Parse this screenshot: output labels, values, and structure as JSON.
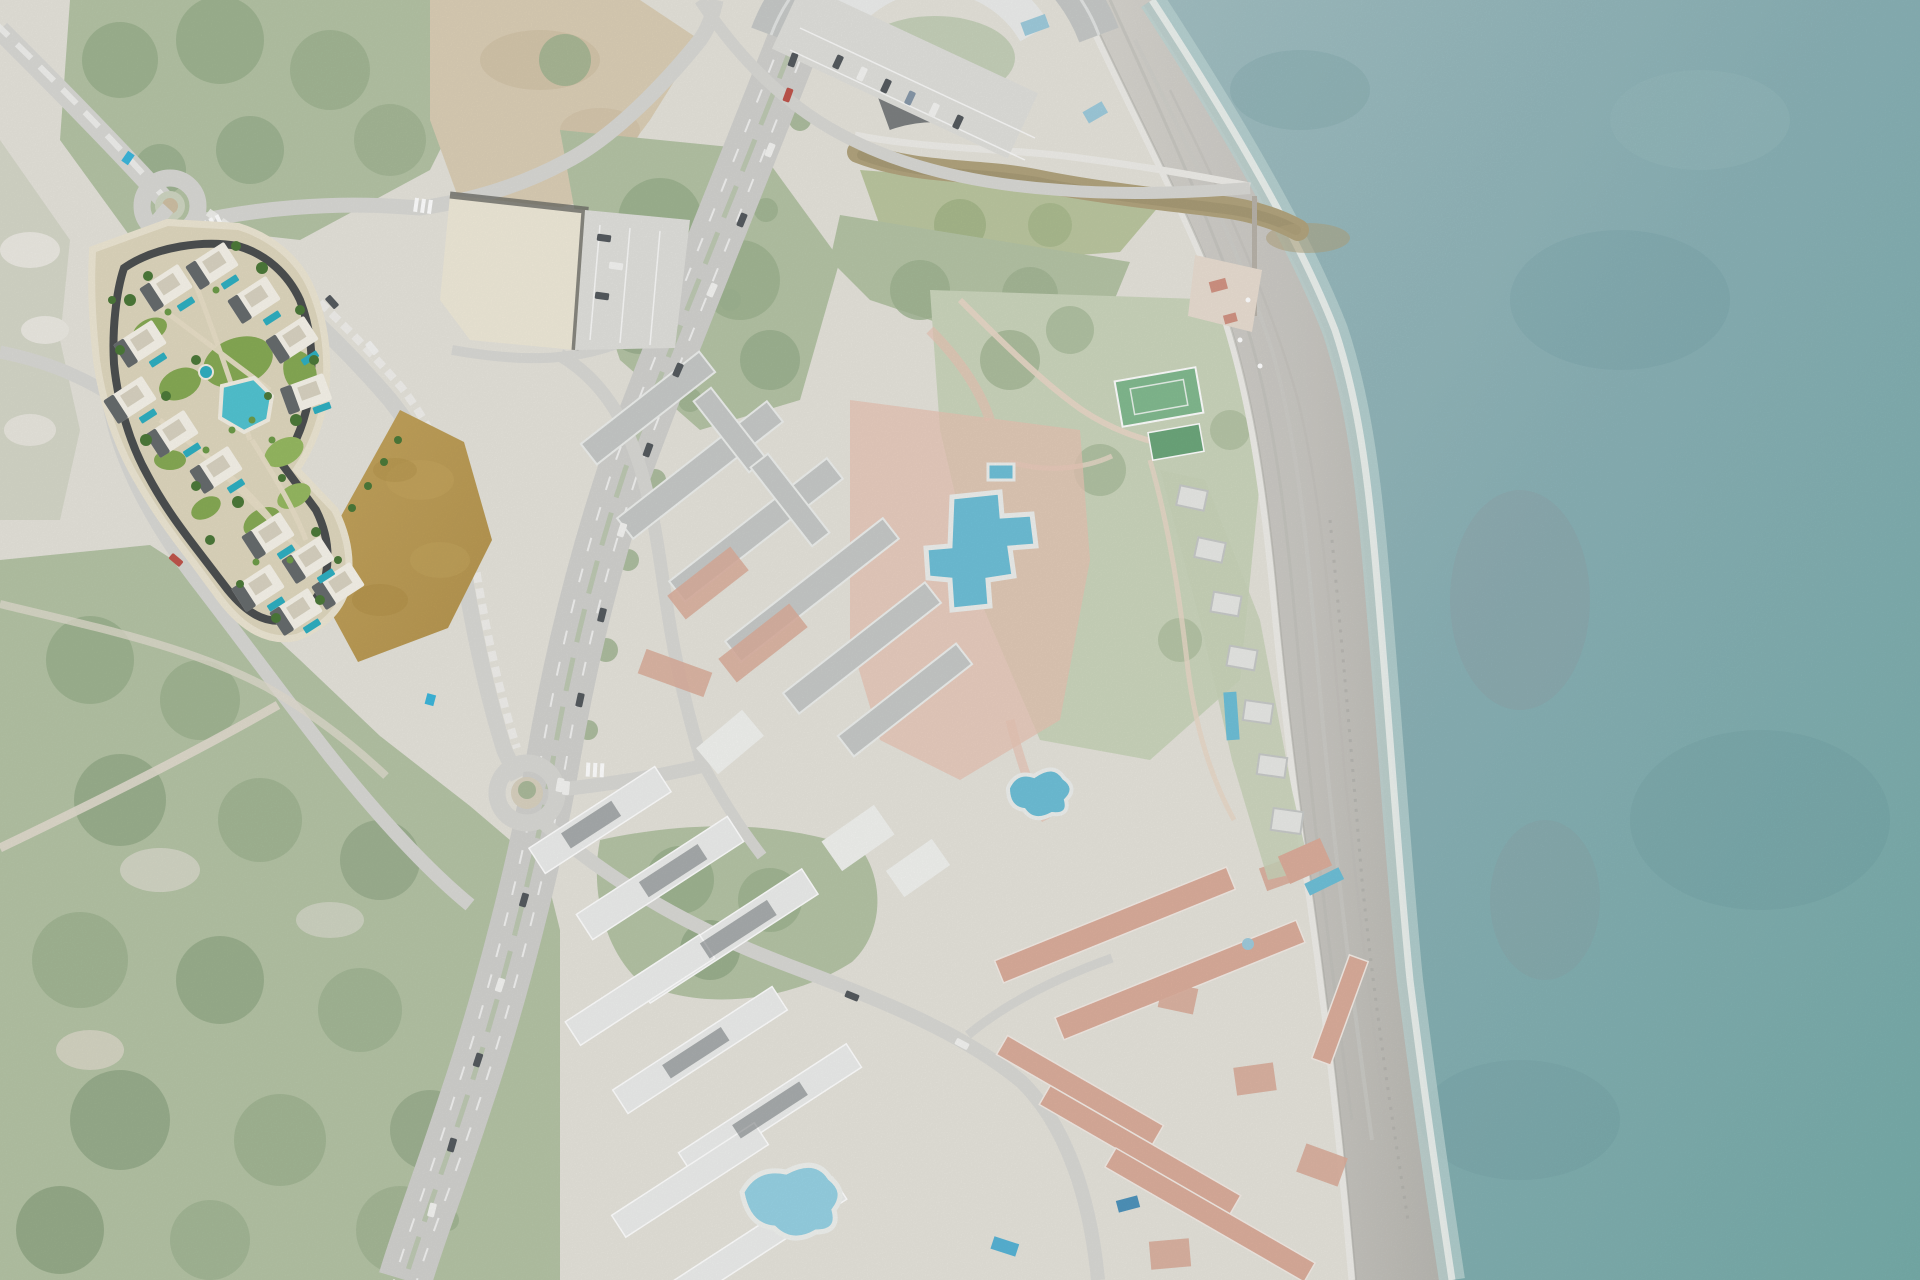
{
  "map": {
    "style": "satellite aerial view of a coastal strip; all surroundings are desaturated / washed out",
    "highlight": "full-colour masterplan render of a new residential development with private pools and a central lagoon pool, upper-left, beside a vacant tan field",
    "regions": [
      "sea",
      "beach",
      "river-mouth",
      "reed-island",
      "circular-apartment-complex",
      "resort-complex-with-pools",
      "white-apartment-blocks",
      "red-roof-townhouses",
      "beachfront-houses",
      "commercial-building",
      "parking-lots",
      "highway",
      "roundabouts",
      "forest-scrubland",
      "tennis-courts",
      "vacant-tan-field"
    ],
    "counts": {
      "roundabouts": 2,
      "tennis_courts": 2,
      "development_private_pools": 13,
      "development_lagoon_pool": 1
    }
  },
  "palette": {
    "land_base": "#e6e4dc",
    "scrub_light": "#d6d8c9",
    "veg_washed": "#b5c4a6",
    "veg_washed_dark": "#9fb491",
    "veg_washed_deep": "#8aa37f",
    "dirt_washed": "#dccfb6",
    "dirt_mottle": "#cfc0a4",
    "dirt_path": "#e3ddd0",
    "road_washed": "#d9d9d5",
    "road_white": "#f2f2ef",
    "highway_washed": "#d2d2cf",
    "parking_washed": "#e1e1dd",
    "building_washed": "#eceeec",
    "roof_gray_washed": "#c7cac8",
    "roof_dark_washed": "#585d61",
    "roof_red_washed": "#dcae9c",
    "terracotta_washed": "#e8c6b6",
    "plaza_washed": "#e9ded2",
    "commercial_roof": "#f0ead9",
    "commercial_edge": "#6e6e68",
    "pool_washed": "#9fccdd",
    "pool_resort": "#6fc0d8",
    "pool_deep_washed": "#4f94bc",
    "court_green": "#83bb90",
    "court_green_dark": "#6da87c",
    "river_water": "#b2a47e",
    "river_dark": "#a1946f",
    "beach_dry": "#d8d6d0",
    "beach_mid": "#cac8c3",
    "beach_wet": "#b9b8b2",
    "beach_streak": "#c0bfba",
    "foam": "#f0f4f1",
    "shallow": "#bed7d6",
    "sea_near": "#a3c0c3",
    "sea_mid": "#8bb2b7",
    "sea_deep": "#77adaa",
    "sea_dark_patch": "#5e8f96",
    "reef_patch": "#9c8e96",
    "promenade": "#efeee9",
    "seawall": "#b0afaa",
    "site_ground": "#e0d8bf",
    "site_sidewalk": "#eee7d4",
    "site_road": "#45494b",
    "site_path": "#e9e0c8",
    "site_lawn": "#87ab55",
    "site_lawn_bright": "#97ba62",
    "site_tree": "#4d7a3a",
    "site_palm": "#6d9c49",
    "site_building": "#f7f4ea",
    "site_roof_terrace": "#d9d3c2",
    "site_roof_dark": "#4e5458",
    "site_pool": "#2fb0c2",
    "site_pool_bright": "#52c4d2",
    "field_tan": "#b6954f",
    "field_tan_light": "#c4a55e",
    "field_tan_dark": "#a8893f",
    "car_dark": "#565b60",
    "car_white": "#f4f4f2",
    "car_red": "#c0554c",
    "cyan_mark": "#3db7dc",
    "kiosk_red": "#d29484"
  }
}
